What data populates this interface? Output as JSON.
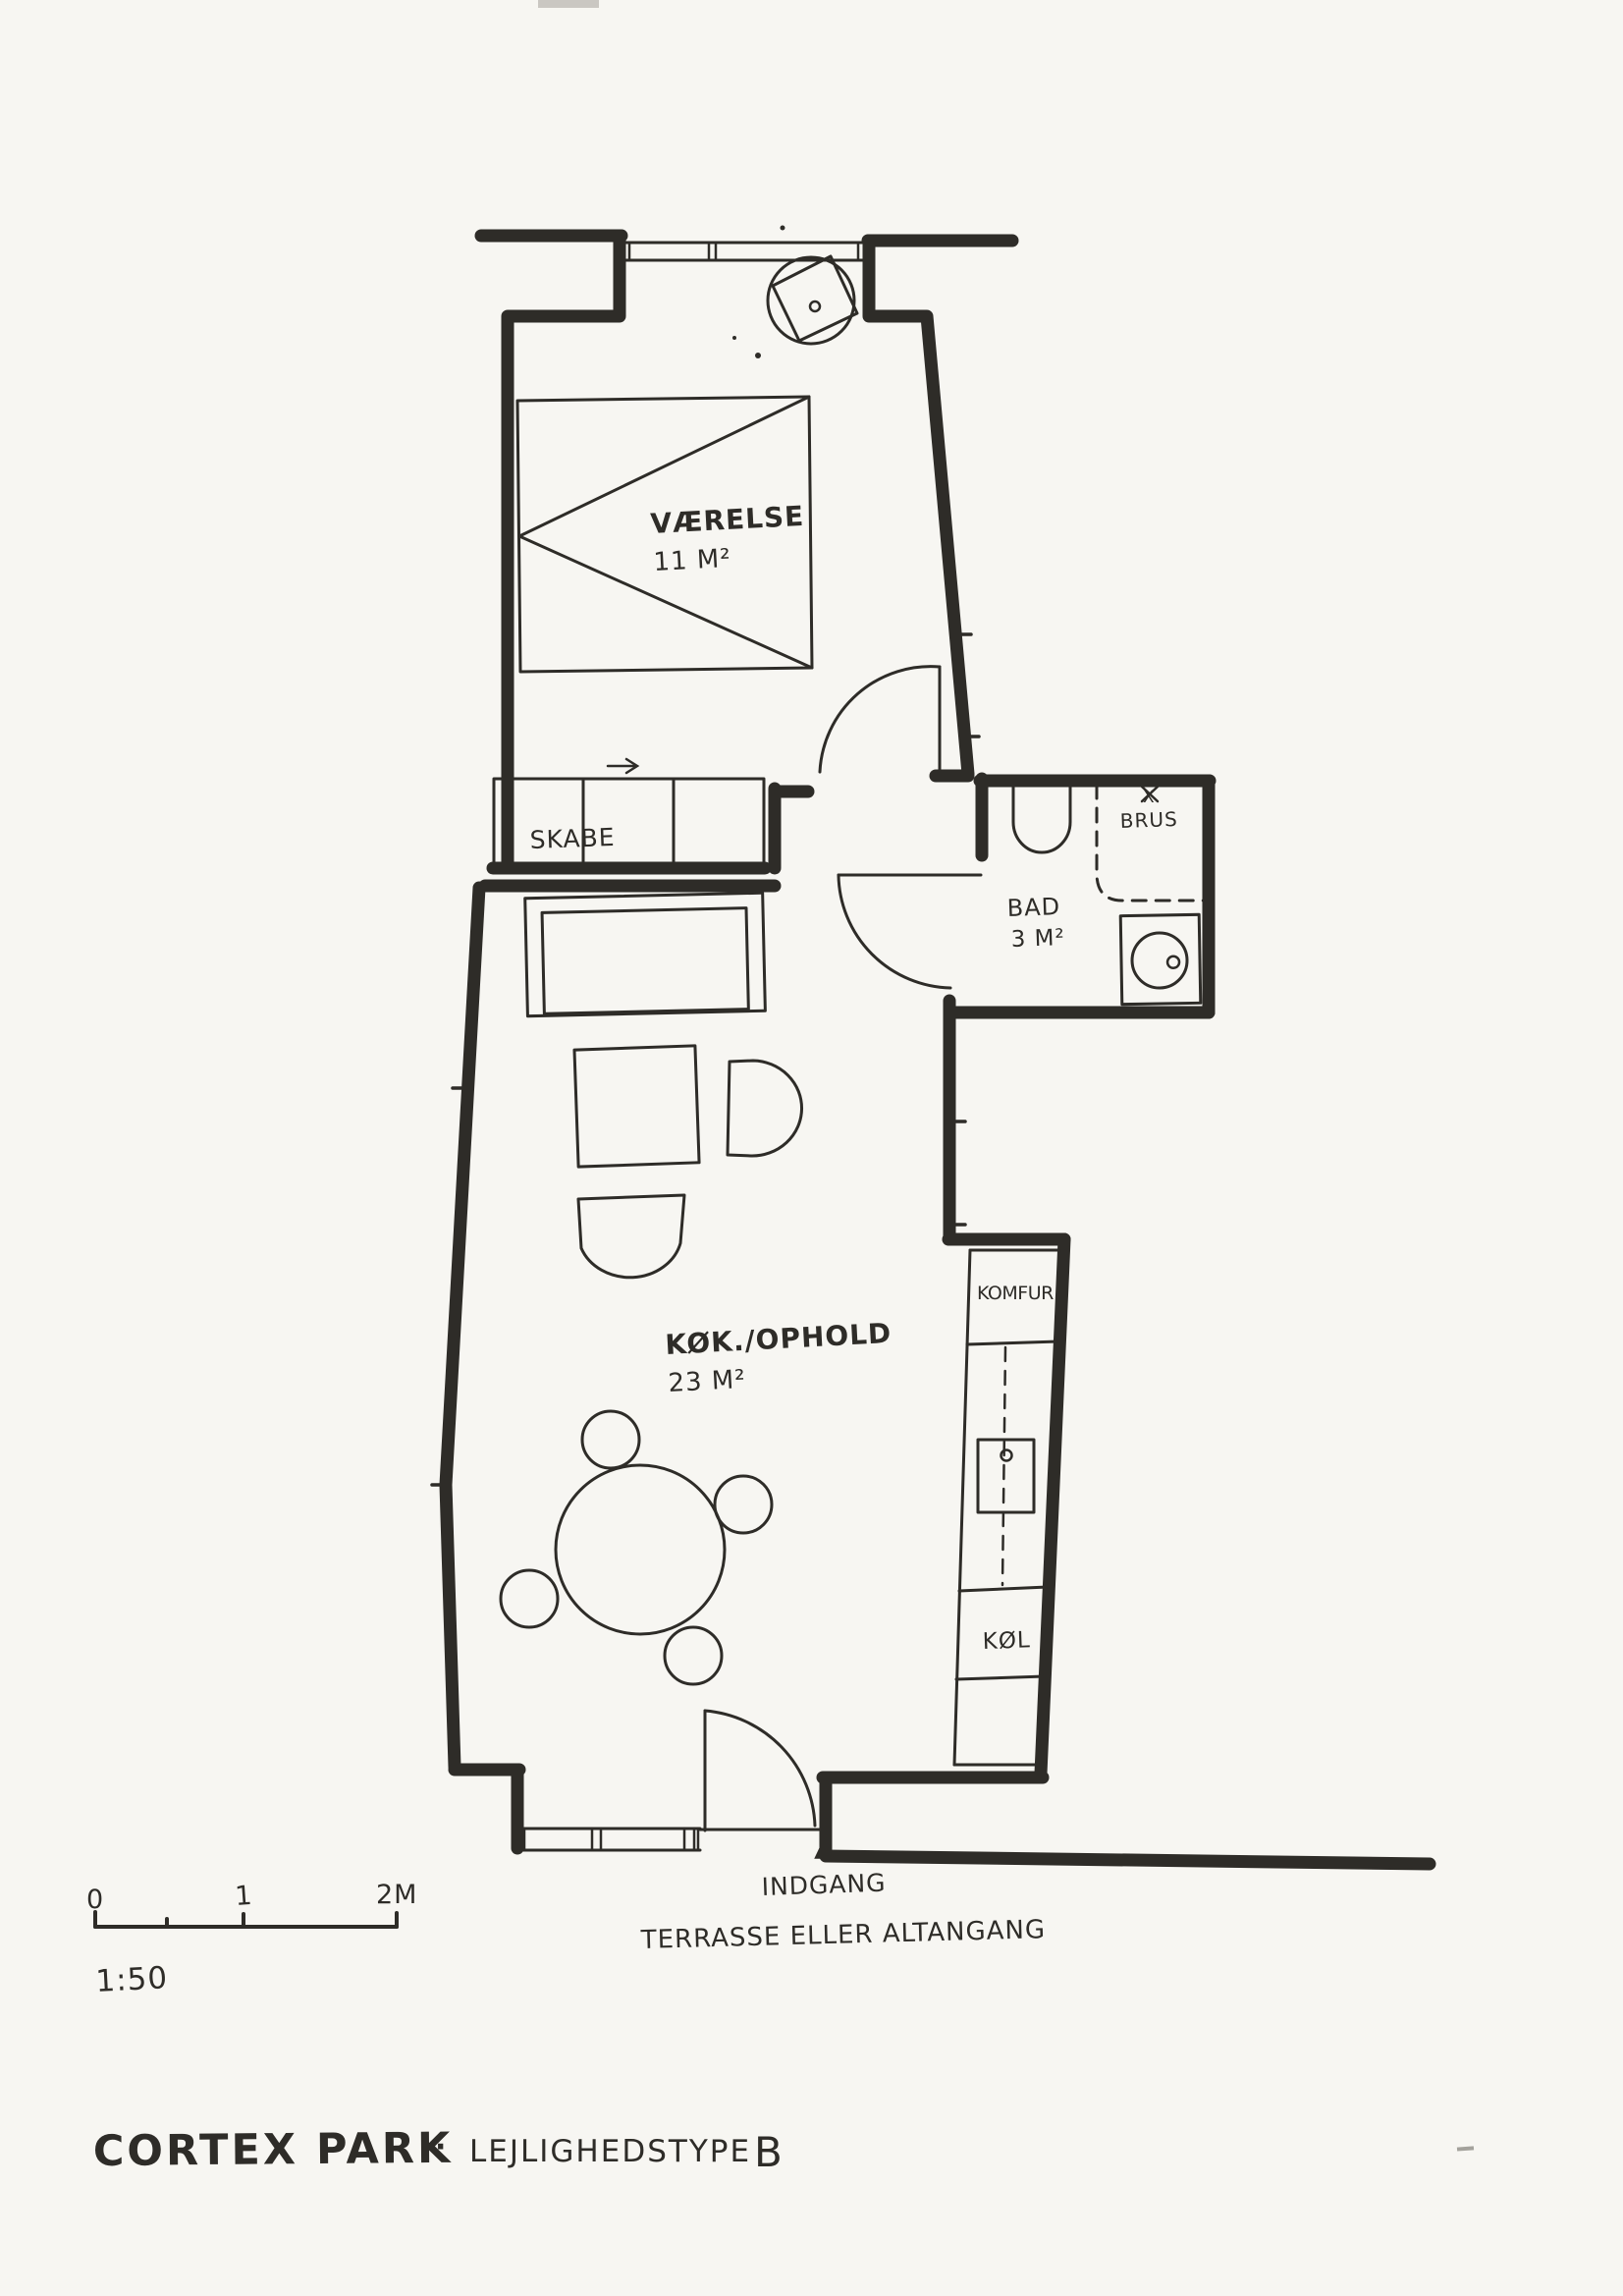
{
  "colors": {
    "ink": "#2e2c28",
    "paper": "#f7f6f2"
  },
  "plan": {
    "rooms": {
      "bedroom": {
        "name": "VÆRELSE",
        "area": "11 M²"
      },
      "bathroom": {
        "name": "BAD",
        "area": "3 M²"
      },
      "kitchen_living": {
        "name": "KØK./OPHOLD",
        "area": "23 M²"
      }
    },
    "fixtures": {
      "wardrobe": "SKABE",
      "shower": "BRUS",
      "shower_mark": "X",
      "stove": "KOMFUR",
      "fridge": "KØL"
    },
    "annotations": {
      "entrance": "INDGANG",
      "terrace": "TERRASSE ELLER ALTANGANG"
    }
  },
  "scale_bar": {
    "tick_0": "0",
    "tick_1": "1",
    "tick_2": "2M",
    "ratio": "1:50"
  },
  "title_block": {
    "project": "CORTEX PARK",
    "separator": "·",
    "label": "LEJLIGHEDSTYPE",
    "unit_type": "B"
  }
}
